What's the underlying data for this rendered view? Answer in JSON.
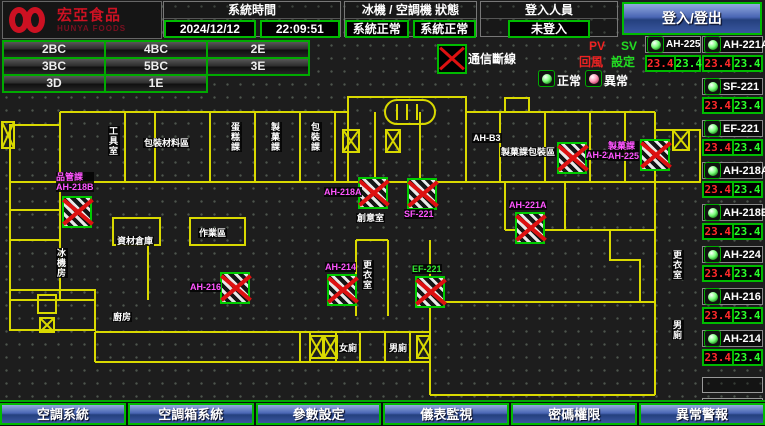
{
  "header": {
    "logo": {
      "brand": "宏亞食品",
      "brand_sub": "HUNYA FOODS"
    },
    "system_time_label": "系統時間",
    "date": "2024/12/12",
    "time": "22:09:51",
    "chiller_status_label": "冰機 / 空調機 狀態",
    "chiller_status": "系統正常",
    "ahu_status": "系統正常",
    "login_label": "登入人員",
    "login_status": "未登入",
    "login_button": "登入/登出"
  },
  "floor_rows": [
    [
      "2BC",
      "4BC",
      "2E"
    ],
    [
      "3BC",
      "5BC",
      "3E"
    ],
    [
      "3D",
      "1E"
    ]
  ],
  "legend": {
    "comm_loss": "通信斷線",
    "pv": "PV",
    "sv": "SV",
    "return_air": "回風",
    "setpoint": "設定",
    "normal": "正常",
    "abnormal": "異常"
  },
  "equipment_left": [
    {
      "name": "AH-225",
      "pv": "23.4",
      "sv": "23.4"
    }
  ],
  "equipment": [
    {
      "name": "AH-221A",
      "pv": "23.4",
      "sv": "23.4"
    },
    {
      "name": "SF-221",
      "pv": "23.4",
      "sv": "23.4"
    },
    {
      "name": "EF-221",
      "pv": "23.4",
      "sv": "23.4"
    },
    {
      "name": "AH-218A",
      "pv": "23.4",
      "sv": "23.4"
    },
    {
      "name": "AH-218B",
      "pv": "23.4",
      "sv": "23.4"
    },
    {
      "name": "AH-224",
      "pv": "23.4",
      "sv": "23.4"
    },
    {
      "name": "AH-216",
      "pv": "23.4",
      "sv": "23.4"
    },
    {
      "name": "AH-214",
      "pv": "23.4",
      "sv": "23.4"
    }
  ],
  "empty_slots": 2,
  "map": {
    "devices": [
      {
        "name": "AH-218B",
        "x": 62,
        "y": 106,
        "lx": -6,
        "ly": -24,
        "lines": [
          "品管課",
          "AH-218B"
        ]
      },
      {
        "name": "AH-216",
        "x": 220,
        "y": 182,
        "lx": -30,
        "ly": 10
      },
      {
        "name": "AH-214",
        "x": 327,
        "y": 184,
        "lx": -2,
        "ly": -12
      },
      {
        "name": "AH-218A",
        "x": 358,
        "y": 87,
        "lx": -34,
        "ly": 10
      },
      {
        "name": "SF-221",
        "x": 407,
        "y": 88,
        "lx": -3,
        "ly": 31
      },
      {
        "name": "EF-221",
        "x": 415,
        "y": 186,
        "lx": -3,
        "ly": -12,
        "color": "green"
      },
      {
        "name": "AH-221A",
        "x": 515,
        "y": 122,
        "lx": -6,
        "ly": -12
      },
      {
        "name": "AH-224",
        "x": 557,
        "y": 52,
        "lx": 29,
        "ly": 8
      },
      {
        "name": "AH-225",
        "x": 640,
        "y": 49,
        "lx": -32,
        "ly": 2,
        "lines": [
          "製菓課",
          "AH-225"
        ]
      }
    ],
    "rooms": [
      {
        "t": "工具室",
        "x": 108,
        "y": 36,
        "v": true
      },
      {
        "t": "包裝材料區",
        "x": 143,
        "y": 48
      },
      {
        "t": "蛋糕課",
        "x": 230,
        "y": 32,
        "v": true
      },
      {
        "t": "製菓課",
        "x": 270,
        "y": 32,
        "v": true
      },
      {
        "t": "包裝課",
        "x": 310,
        "y": 32,
        "v": true
      },
      {
        "t": "AH-B3",
        "x": 472,
        "y": 43
      },
      {
        "t": "製菓課包裝區",
        "x": 500,
        "y": 57
      },
      {
        "t": "資材倉庫",
        "x": 116,
        "y": 146
      },
      {
        "t": "作業區",
        "x": 198,
        "y": 138
      },
      {
        "t": "創意室",
        "x": 356,
        "y": 123
      },
      {
        "t": "更衣室",
        "x": 362,
        "y": 170,
        "v": true
      },
      {
        "t": "更衣室",
        "x": 672,
        "y": 160,
        "v": true
      },
      {
        "t": "男廁",
        "x": 672,
        "y": 230,
        "v": true
      },
      {
        "t": "女廁",
        "x": 338,
        "y": 253
      },
      {
        "t": "男廁",
        "x": 388,
        "y": 253
      },
      {
        "t": "廚房",
        "x": 112,
        "y": 222
      },
      {
        "t": "冰機房",
        "x": 56,
        "y": 158,
        "v": true
      }
    ]
  },
  "nav": [
    "空調系統",
    "空調箱系統",
    "參數設定",
    "儀表監視",
    "密碼權限",
    "異常警報"
  ]
}
